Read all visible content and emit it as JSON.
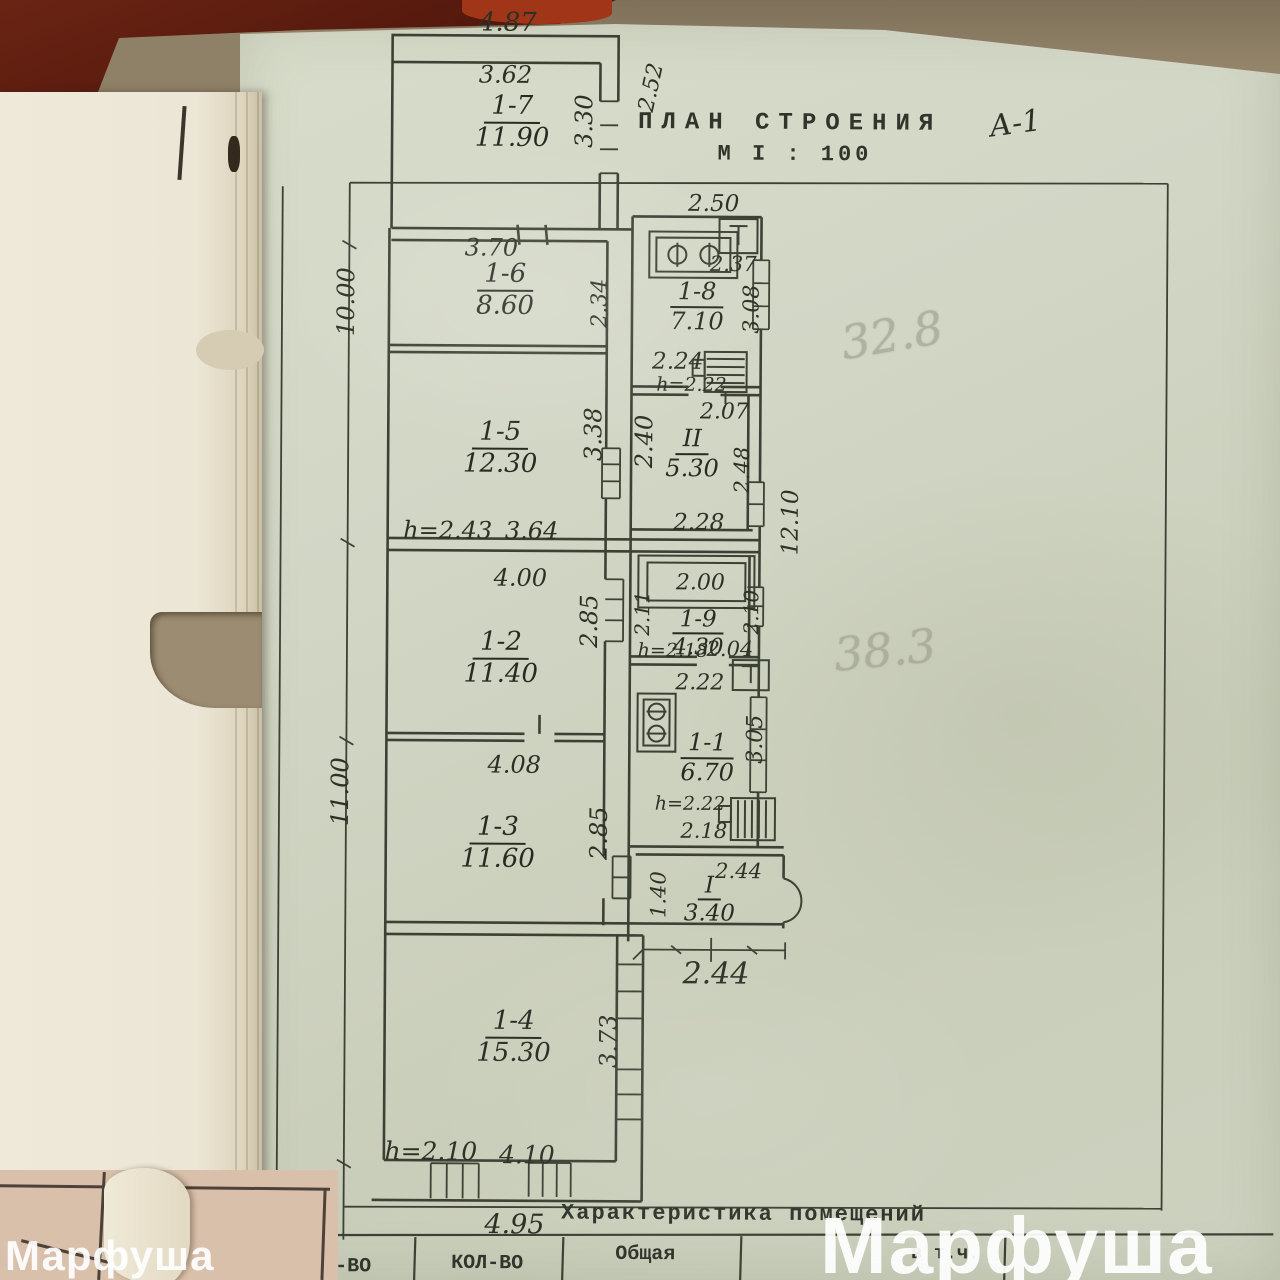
{
  "header": {
    "title_line1": "ПЛАН СТРОЕНИЯ",
    "title_line2": "М I : 100",
    "litera": "А-1"
  },
  "pencil": {
    "upper": "32.8",
    "lower": "38.3"
  },
  "watermarks": {
    "small": "Марфуша",
    "large": "Марфуша"
  },
  "table": {
    "title": "Характеристика помещений",
    "col_1": "КОЛ-ВО",
    "col_2": "КОЛ-ВО",
    "col_3": "Общая",
    "col_4": "в т.ч."
  },
  "rooms": {
    "r1_7": {
      "num": "1-7",
      "area": "11.90"
    },
    "r1_6": {
      "num": "1-6",
      "area": "8.60"
    },
    "r1_5": {
      "num": "1-5",
      "area": "12.30"
    },
    "r1_2": {
      "num": "1-2",
      "area": "11.40"
    },
    "r1_3": {
      "num": "1-3",
      "area": "11.60"
    },
    "r1_4": {
      "num": "1-4",
      "area": "15.30"
    },
    "r1_8": {
      "num": "1-8",
      "area": "7.10"
    },
    "rII": {
      "num": "II",
      "area": "5.30"
    },
    "r1_9": {
      "num": "1-9",
      "area": "4.30"
    },
    "r1_1": {
      "num": "1-1",
      "area": "6.70"
    },
    "rI": {
      "num": "I",
      "area": "3.40"
    }
  },
  "dims": {
    "top_width": "4.87",
    "r17_w": "3.62",
    "r17_h": "3.30",
    "r17_side": "2.52",
    "left_upper": "10.00",
    "left_lower": "11.00",
    "right_total": "12.10",
    "r16_w": "3.70",
    "r16_h": "2.34",
    "r18_w_top": "2.50",
    "r18_w_in": "2.37",
    "r18_h": "3.08",
    "r18_w_bot": "2.24",
    "r18_ceil": "h=2.22",
    "rII_w_top": "2.07",
    "rII_h_left": "2.40",
    "rII_h_right": "2.48",
    "rII_w_bot": "2.28",
    "r15_h": "3.38",
    "r15_ceil": "h=2.43",
    "r15_w": "3.64",
    "closet_w": "2.00",
    "r19_h_left": "2.11",
    "r19_h_right": "2.10",
    "r19_ceil": "h=2.18",
    "r19_w_bot": "2.04",
    "r12_w": "4.00",
    "r12_h": "2.85",
    "r11_w_top": "2.22",
    "r11_h": "3.05",
    "r11_ceil": "h=2.22",
    "r11_w_bot": "2.18",
    "r13_w": "4.08",
    "r13_h": "2.85",
    "rI_w_top": "2.44",
    "rI_h_left": "1.40",
    "porch_bottom": "2.44",
    "r14_h": "3.73",
    "r14_ceil": "h=2.10",
    "r14_w": "4.10",
    "bottom_w": "4.95"
  }
}
